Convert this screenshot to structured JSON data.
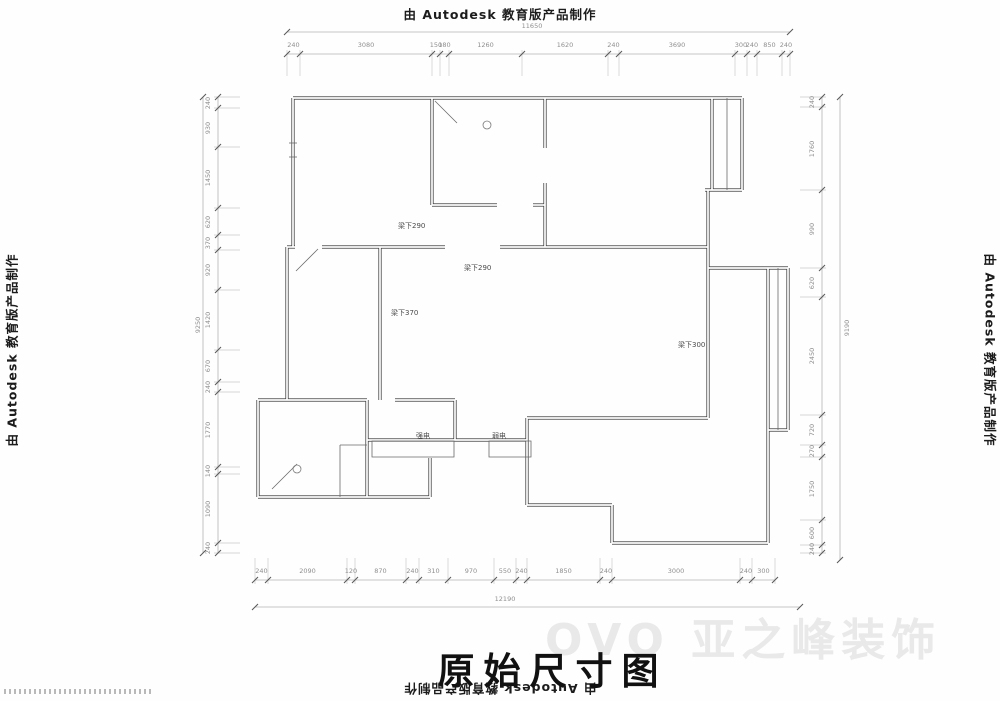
{
  "watermarks": {
    "autodesk": "由 Autodesk 教育版产品制作",
    "ghost": "OVO 亚之峰装饰"
  },
  "title": "原始尺寸图",
  "labels": {
    "beam1": "梁下290",
    "beam2": "梁下290",
    "beam3": "梁下370",
    "beam4": "梁下300",
    "strong": "强电",
    "weak": "弱电"
  },
  "dimensions": {
    "top": {
      "overall": "11650",
      "segments": [
        "240",
        "3080",
        "150",
        "180",
        "1260",
        "1620",
        "240",
        "3690",
        "300",
        "240",
        "850",
        "240"
      ]
    },
    "bottom": {
      "overall": "12190",
      "segments": [
        "240",
        "2090",
        "120",
        "870",
        "240",
        "310",
        "970",
        "550",
        "240",
        "1850",
        "240",
        "3000",
        "240",
        "300"
      ]
    },
    "left": {
      "overall": "9250",
      "segments": [
        "240",
        "930",
        "1450",
        "620",
        "370",
        "920",
        "1420",
        "670",
        "240",
        "1770",
        "140",
        "1090",
        "240"
      ]
    },
    "right": {
      "overall": "9190",
      "segments": [
        "240",
        "1760",
        "990",
        "620",
        "2450",
        "720",
        "270",
        "1750",
        "600",
        "240"
      ]
    }
  }
}
